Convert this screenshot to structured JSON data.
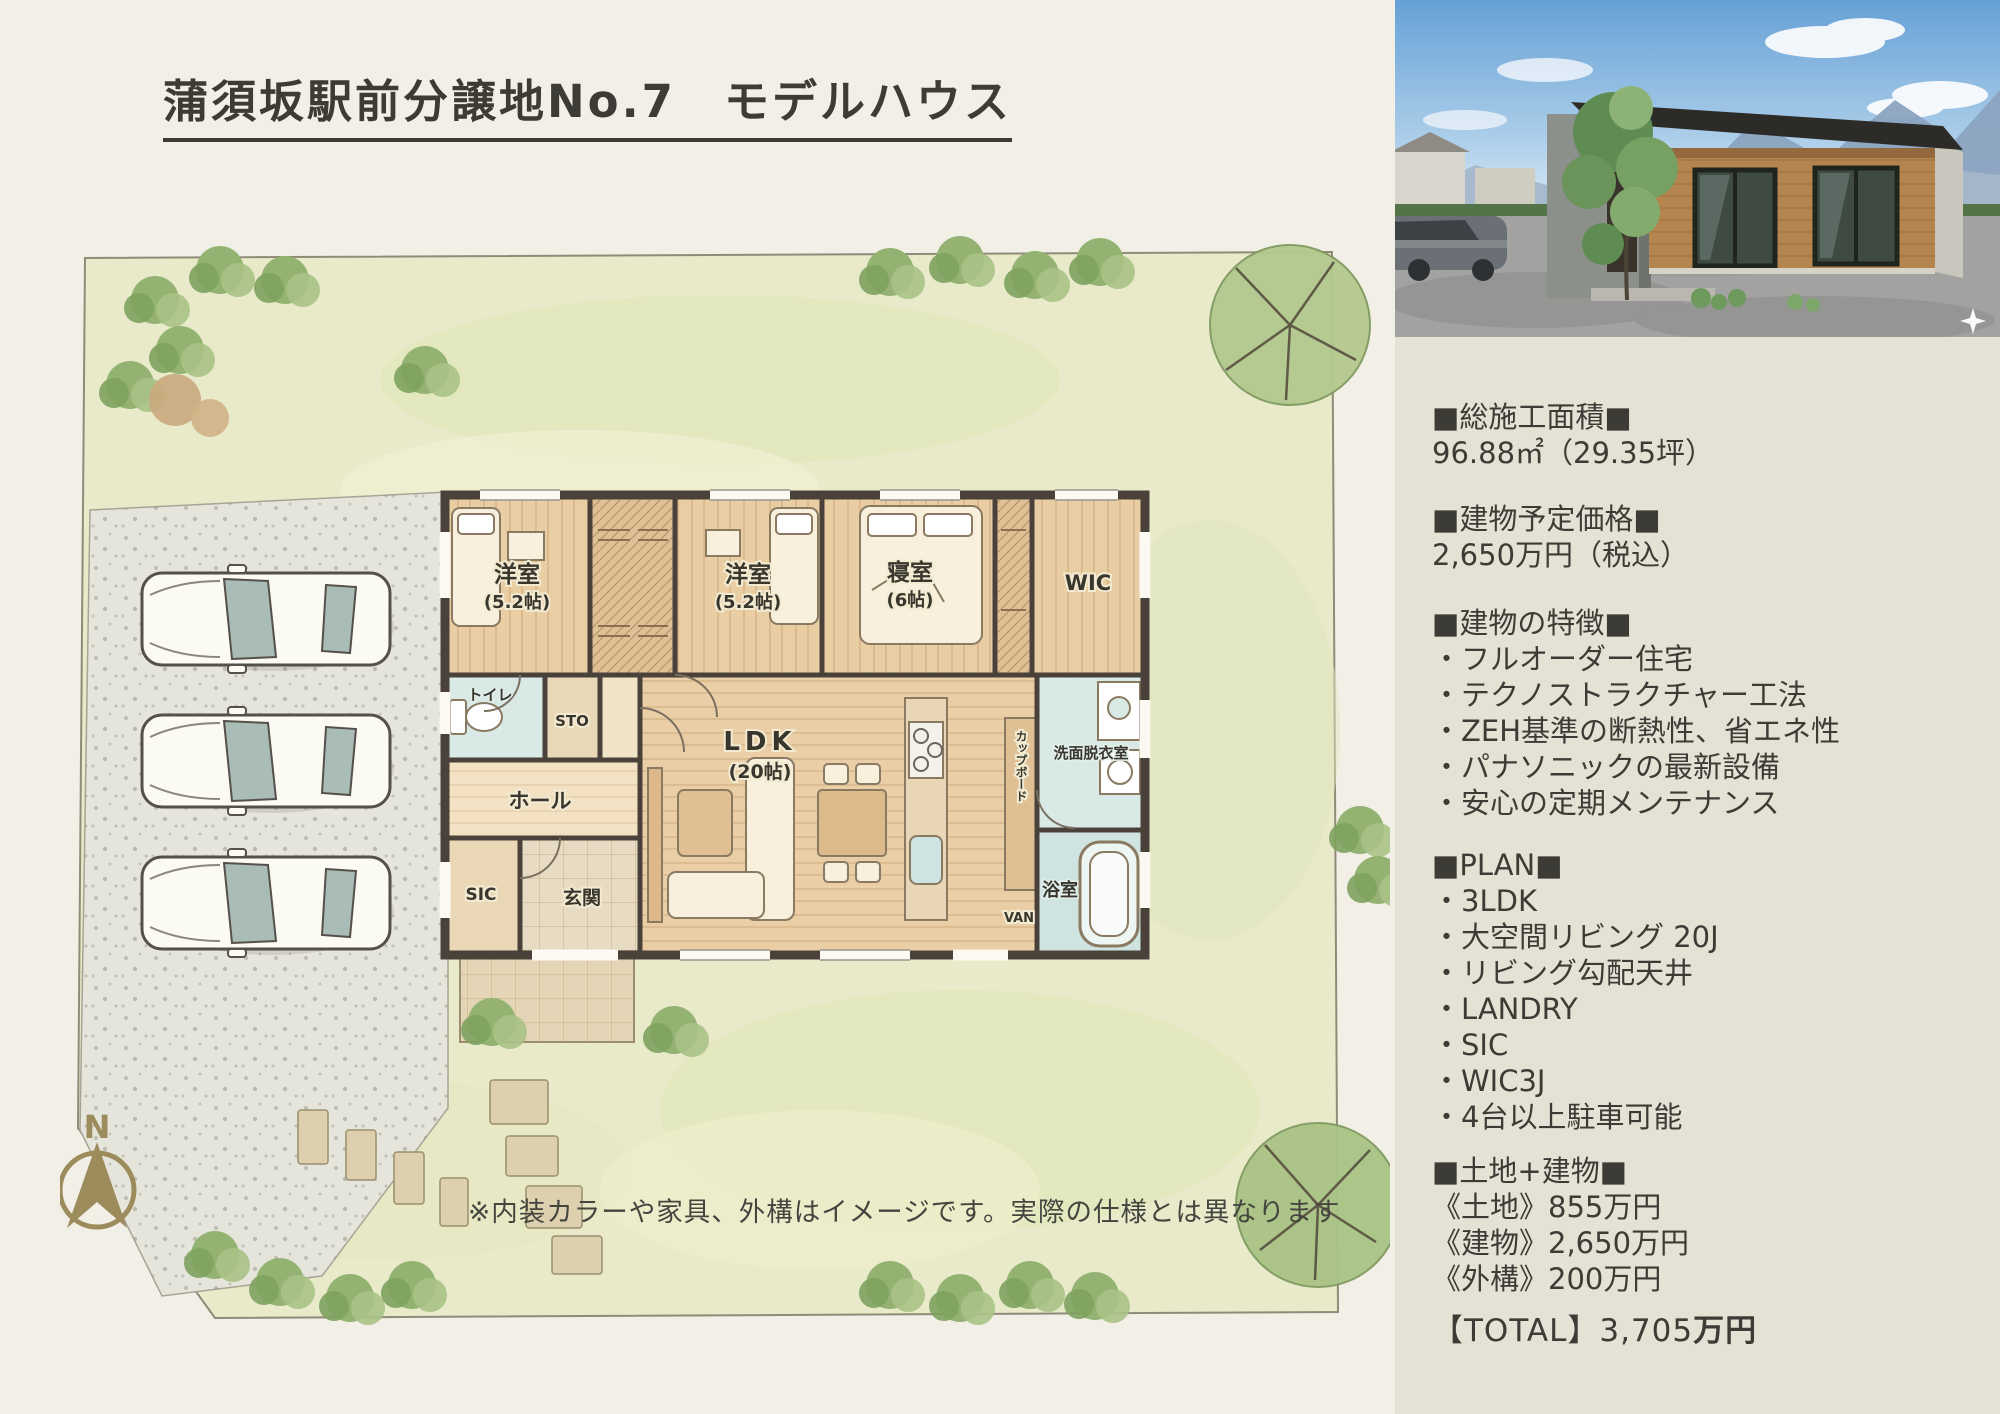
{
  "page": {
    "title": "蒲須坂駅前分譲地No.7　モデルハウス",
    "note": "※内装カラーや家具、外構はイメージです。実際の仕様とは異なります",
    "compass": "N"
  },
  "plan": {
    "rooms": {
      "bedroom1": "洋室",
      "bedroom1_size": "(5.2帖)",
      "bedroom2": "洋室",
      "bedroom2_size": "(5.2帖)",
      "master": "寝室",
      "master_size": "(6帖)",
      "wic": "WIC",
      "toilet": "トイレ",
      "sto": "STO",
      "hall": "ホール",
      "ldk": "LDK",
      "ldk_size": "(20帖)",
      "sic": "SIC",
      "entrance": "玄関",
      "washroom": "洗面脱衣室",
      "bath": "浴室",
      "van": "VAN",
      "cupboard": "カップボード"
    }
  },
  "sidebar": {
    "area": {
      "heading": "■総施工面積■",
      "value": "96.88㎡（29.35坪）"
    },
    "price": {
      "heading": "■建物予定価格■",
      "value": "2,650万円（税込）"
    },
    "features": {
      "heading": "■建物の特徴■",
      "items": [
        "・フルオーダー住宅",
        "・テクノストラクチャー工法",
        "・ZEH基準の断熱性、省エネ性",
        "・パナソニックの最新設備",
        "・安心の定期メンテナンス"
      ]
    },
    "plan": {
      "heading": "■PLAN■",
      "items": [
        "・3LDK",
        "・大空間リビング 20J",
        "・リビング勾配天井",
        "・LANDRY",
        "・SIC",
        "・WIC3J",
        "・4台以上駐車可能"
      ]
    },
    "land_building": {
      "heading": "■土地+建物■",
      "items": [
        "《土地》855万円",
        "《建物》2,650万円",
        "《外構》200万円"
      ]
    },
    "total": {
      "prefix": "【TOTAL】3,705",
      "suffix": "万円"
    }
  },
  "colors": {
    "page_bg": "#f2efe6",
    "sidebar_bg": "#e5e1d4",
    "text": "#3d3b36",
    "compass_gold": "#9c8c5c",
    "lawn": "#e8eac9",
    "wood_floor": "#eacfa6",
    "wet_room": "#d9e9e6"
  }
}
